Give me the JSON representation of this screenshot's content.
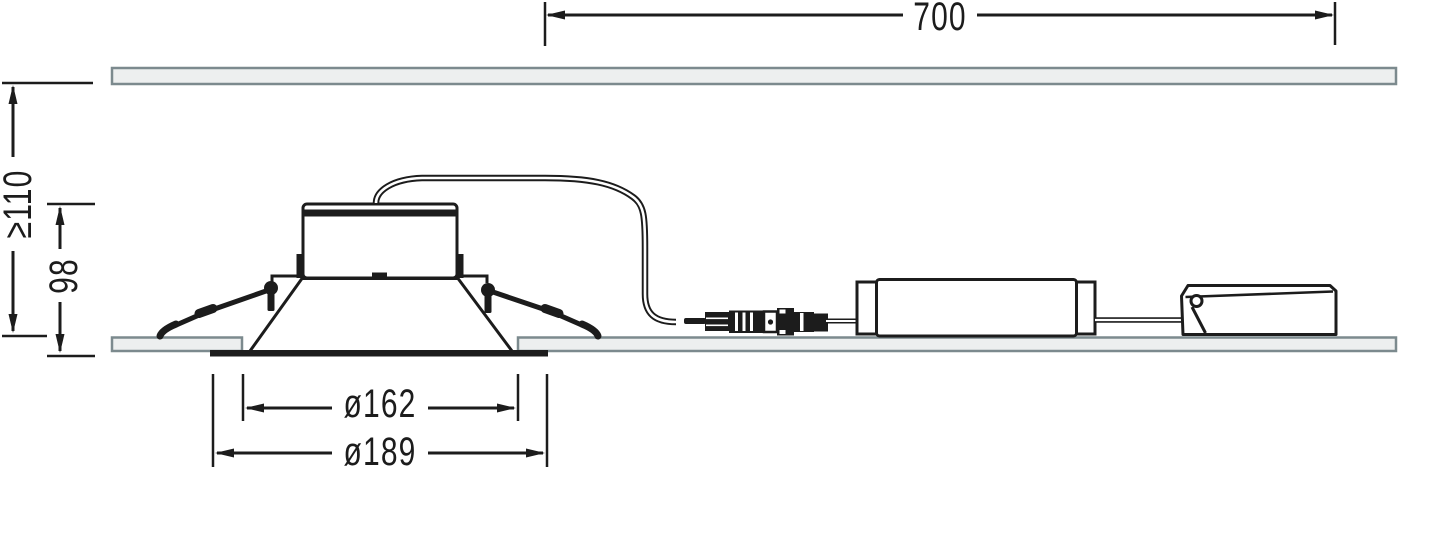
{
  "drawing": {
    "kind": "recessed-downlight-mounting-dimension-drawing",
    "dimensions": {
      "cable_run": {
        "label": "700"
      },
      "min_recess_depth": {
        "label": "≥110"
      },
      "housing_height": {
        "label": "98"
      },
      "cutout_diameter": {
        "label": "ø162"
      },
      "overall_diameter": {
        "label": "ø189"
      }
    }
  },
  "colors": {
    "line": "#1c1c1c",
    "panel_fill": "#edefef",
    "panel_border": "#7c8a8e",
    "background": "#ffffff"
  }
}
